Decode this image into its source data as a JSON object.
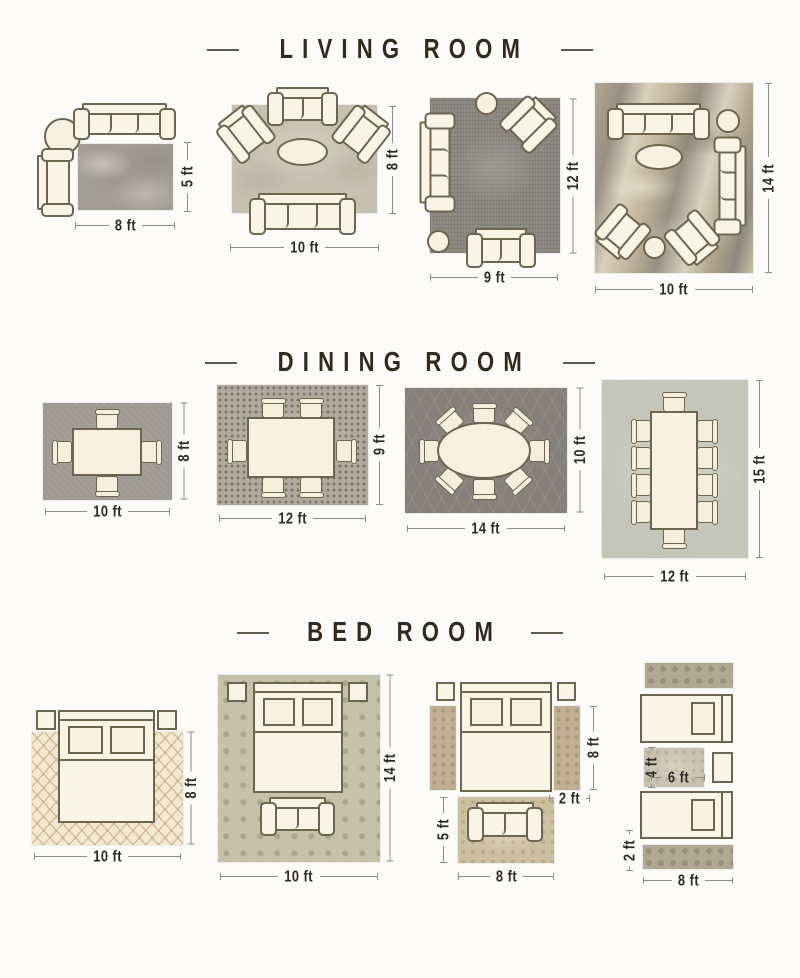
{
  "background": "#fcfbf7",
  "palette": {
    "furniture_fill": "#faf4e7",
    "furniture_outline": "#6e6450",
    "title_text": "#35291e",
    "dim_text": "#2e2a25",
    "dim_line": "#8b8b8b"
  },
  "sections": [
    {
      "title": "LIVING ROOM",
      "layouts": [
        {
          "name": "living-rug-8x5",
          "width": "8 ft",
          "height": "5 ft"
        },
        {
          "name": "living-rug-10x8",
          "width": "10 ft",
          "height": "8 ft"
        },
        {
          "name": "living-rug-9x12",
          "width": "9 ft",
          "height": "12 ft"
        },
        {
          "name": "living-rug-10x14",
          "width": "10 ft",
          "height": "14 ft"
        }
      ]
    },
    {
      "title": "DINING ROOM",
      "layouts": [
        {
          "name": "dining-rug-10x8",
          "width": "10 ft",
          "height": "8 ft"
        },
        {
          "name": "dining-rug-12x9",
          "width": "12 ft",
          "height": "9 ft"
        },
        {
          "name": "dining-rug-14x10",
          "width": "14 ft",
          "height": "10 ft"
        },
        {
          "name": "dining-rug-12x15",
          "width": "12 ft",
          "height": "15 ft"
        }
      ]
    },
    {
      "title": "BED ROOM",
      "layouts": [
        {
          "name": "bedroom-rug-10x8",
          "width": "10 ft",
          "height": "8 ft"
        },
        {
          "name": "bedroom-rug-10x14",
          "width": "10 ft",
          "height": "14 ft"
        },
        {
          "name": "bedroom-queen-runners",
          "width": "8 ft",
          "height": "8 ft",
          "runner_width": "2 ft",
          "front_rug_height": "5 ft"
        },
        {
          "name": "bedroom-twin-runners",
          "width": "8 ft",
          "runner_height": "2 ft",
          "mid_rug_width": "6 ft",
          "mid_rug_height": "4 ft"
        }
      ]
    }
  ]
}
